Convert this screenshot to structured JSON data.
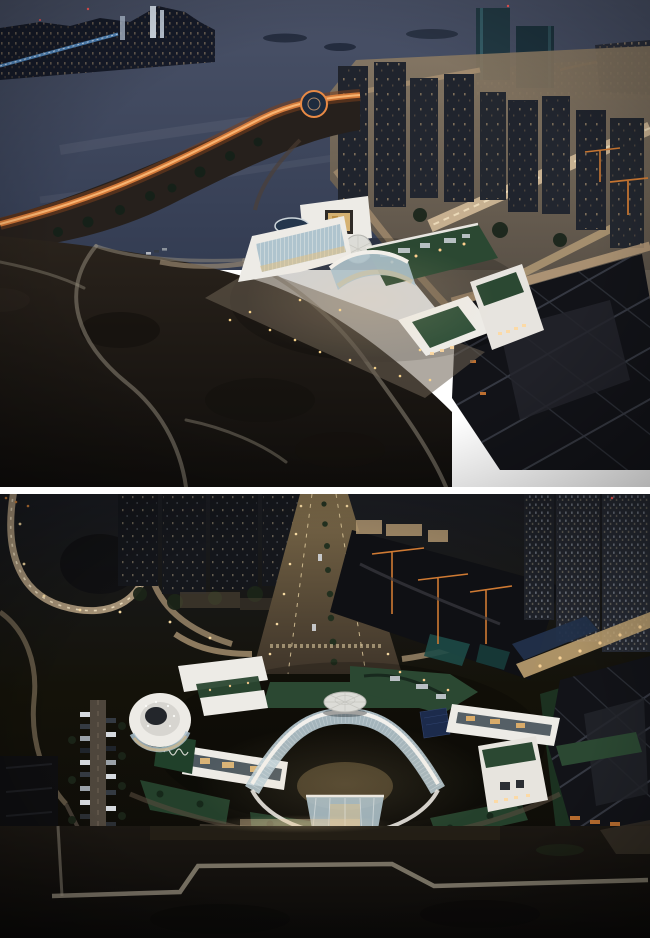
{
  "meta": {
    "width": 650,
    "height": 938,
    "gap_px": 7
  },
  "figures": [
    {
      "id": "top-photo",
      "alt": "Aerial night photo of a white X-shaped building complex beside a dark bay, with a lit city skyline across the water, an orange-lit waterfront promenade, dark residential towers, a construction pit and a dark empty field with light footpaths"
    },
    {
      "id": "bottom-photo",
      "alt": "Closer aerial night photo of the same white butterfly-shaped building with a central round dome, curved glass atrium, green roofs, solar panels, surrounded by lit boulevards, dark towers, a construction site with cranes, a parking street with cars and a dark meadow with a zigzag footpath"
    }
  ],
  "colors": {
    "page_bg": "#ffffff",
    "water_top": "#4a5268",
    "water_deep": "#333c52",
    "skyline_silhouette": "#161b29",
    "warm_light": "#ffd898",
    "warm_light_dim": "#c9ae88",
    "blue_light": "#5d9bd8",
    "red_light": "#ff5a5a",
    "orange_shore": "#e0813c",
    "teal_tower": "#223a44",
    "tower_dark": "#20242d",
    "street_glow": "#cdb28b",
    "building_white": "#edebe6",
    "glass_cool": "#a9c0cc",
    "glass_warm": "#e8c07a",
    "green_roof": "#2b4832",
    "lawn_green": "#31513a",
    "dome_white": "#dcdcd7",
    "field_dark": "#1d1813",
    "path_light": "#98907f",
    "pit_dark": "#121318",
    "brace_gray": "#3a3e47",
    "crane_orange": "#cf7a33",
    "solar_blue": "#1c2b4c",
    "sign_green": "#20402a",
    "tarp_teal": "#1d4a46"
  }
}
